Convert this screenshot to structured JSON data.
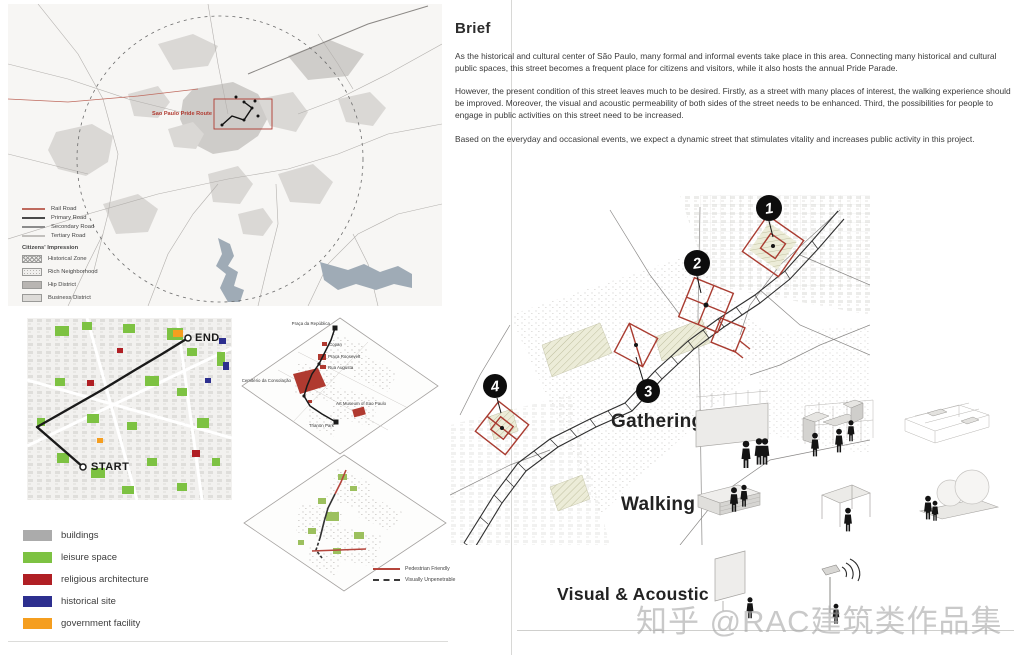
{
  "page": {
    "watermark": "知乎 @RAC建筑类作品集"
  },
  "brief": {
    "title": "Brief",
    "paragraphs": [
      "As the historical and cultural center of São Paulo, many formal and informal events take place in this area. Connecting  many historical and cultural public spaces, this street becomes a frequent place for citizens and visitors, while it also hosts the annual Pride Parade.",
      "However, the present condition of this street leaves much to be desired. Firstly, as a street with many places of interest, the walking experience should be improved. Moreover, the visual and acoustic permeability of both sides of the street needs to be enhanced. Third, the possibilities for people to engage in public activities on this street need to be increased.",
      "Based on the everyday and occasional events, we expect a dynamic street that stimulates vitality and increases public activity in this project."
    ]
  },
  "city_map": {
    "route_label": "Sao Paulo Pride Route",
    "roads_legend": [
      {
        "label": "Rail Road",
        "color": "#bf6a5e"
      },
      {
        "label": "Primary Road",
        "color": "#4a4a4a"
      },
      {
        "label": "Secondary Road",
        "color": "#8c8c8c"
      },
      {
        "label": "Tertiary Road",
        "color": "#c2c0bd"
      }
    ],
    "impression_title": "Citizens' Impression",
    "impression_legend": [
      {
        "label": "Historical Zone",
        "pattern": "crosshatch"
      },
      {
        "label": "Rich Neighborhood",
        "pattern": "speckle"
      },
      {
        "label": "Hip District",
        "pattern": "solid"
      },
      {
        "label": "Business District",
        "pattern": "light"
      }
    ]
  },
  "route_map": {
    "start": "START",
    "end": "END"
  },
  "axon_landmarks": {
    "labels": [
      "Praça da República",
      "Copan",
      "Praça Roosevelt",
      "Rua Augusta",
      "Cemitério da Consolação",
      "Art Museum of Sao Paulo",
      "Trianon Park"
    ]
  },
  "permeability_legend": [
    {
      "label": "Pedestrian Friendly",
      "color": "#b5453c"
    },
    {
      "label": "Visually Unpenetrable",
      "color": "#3a3a3a"
    }
  ],
  "building_legend": [
    {
      "label": "buildings",
      "color": "#ababab"
    },
    {
      "label": "leisure space",
      "color": "#7dc242"
    },
    {
      "label": "religious architecture",
      "color": "#b01f24"
    },
    {
      "label": "historical site",
      "color": "#2d2f8f"
    },
    {
      "label": "government facility",
      "color": "#f59e1f"
    }
  ],
  "street_map": {
    "highlight_color": "#a93c31",
    "nodes": [
      "1",
      "2",
      "3",
      "4"
    ],
    "section_labels": {
      "gathering": "Gathering",
      "walking": "Walking",
      "visual_acoustic": "Visual & Acoustic"
    }
  }
}
